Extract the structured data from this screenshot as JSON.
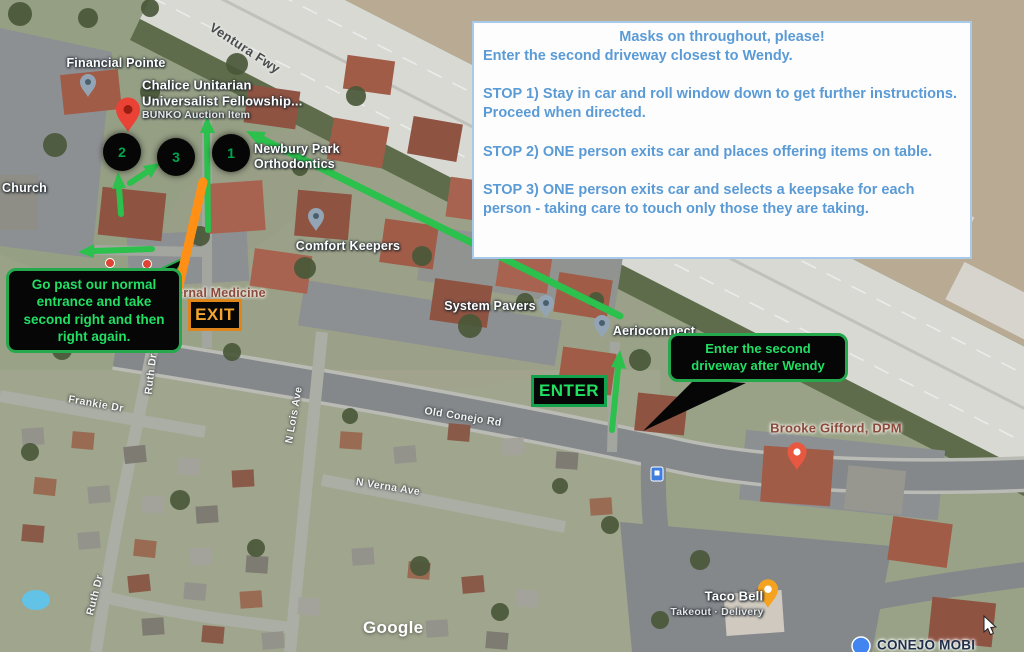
{
  "annotations": {
    "instruction_box": {
      "title": "Masks on throughout, please!",
      "intro": "Enter the second driveway closest to Wendy.",
      "stop1": "STOP 1) Stay in car and roll window down to get further instructions. Proceed when directed.",
      "stop2": "STOP 2) ONE person exits car and places offering items on table.",
      "stop3": "STOP 3) ONE person exits car and selects a keepsake for each person - taking care to touch only those they are taking."
    },
    "callout_left": "Go past our normal entrance and take second right and then right again.",
    "callout_right": "Enter the second driveway after Wendy",
    "exit_label": "EXIT",
    "enter_label": "ENTER",
    "stop_markers": [
      {
        "number": "1"
      },
      {
        "number": "2"
      },
      {
        "number": "3"
      }
    ],
    "colors": {
      "instruction_text": "#5b9bd5",
      "annotation_green": "#21df63",
      "annotation_orange": "#f4a52f",
      "arrow_green": "#2cc04c",
      "arrow_orange": "#ff9015"
    }
  },
  "map": {
    "places": {
      "financial_pointe": "Financial Pointe",
      "chalice_line1": "Chalice Unitarian",
      "chalice_line2": "Universalist Fellowship...",
      "chalice_subtitle": "BUNKO Auction Item",
      "church": "Church",
      "newbury_line1": "Newbury Park",
      "newbury_line2": "Orthodontics",
      "comfort_keepers": "Comfort Keepers",
      "internal_medicine": "Internal Medicine",
      "system_pavers": "System Pavers",
      "aerioconnect": "Aerioconnect",
      "brooke_gifford": "Brooke Gifford, DPM",
      "taco_bell": "Taco Bell",
      "taco_bell_subtitle": "Takeout · Delivery",
      "conejo_partial": "CONEJO MOBI"
    },
    "streets": {
      "ventura_fwy": "Ventura Fwy",
      "old_conejo_rd": "Old Conejo Rd",
      "frankie_dr": "Frankie Dr",
      "ruth_dr": "Ruth Dr",
      "n_lois_ave": "N Lois Ave",
      "n_verna_ave": "N Verna Ave"
    },
    "watermark": "Google"
  }
}
